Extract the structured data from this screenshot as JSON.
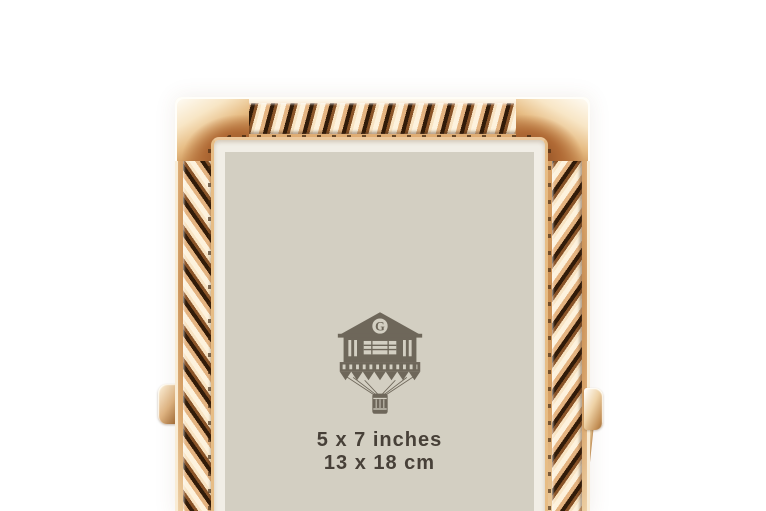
{
  "insert_card": {
    "size_line_inches": "5 x 7 inches",
    "size_line_cm": "13 x 18 cm"
  },
  "logo": {
    "monogram_letter": "G"
  },
  "colors": {
    "background": "#ffffff",
    "gold_highlight": "#fdf4e3",
    "gold_light": "#f0d2a8",
    "gold_mid": "#c98e52",
    "copper_dark": "#8a4a22",
    "rope_shadow": "#311b09",
    "card_margin_ivory": "#f1eee6",
    "card_beige": "#d3cfc2",
    "caption_text": "#474038",
    "logo_ink": "#6e675a"
  }
}
